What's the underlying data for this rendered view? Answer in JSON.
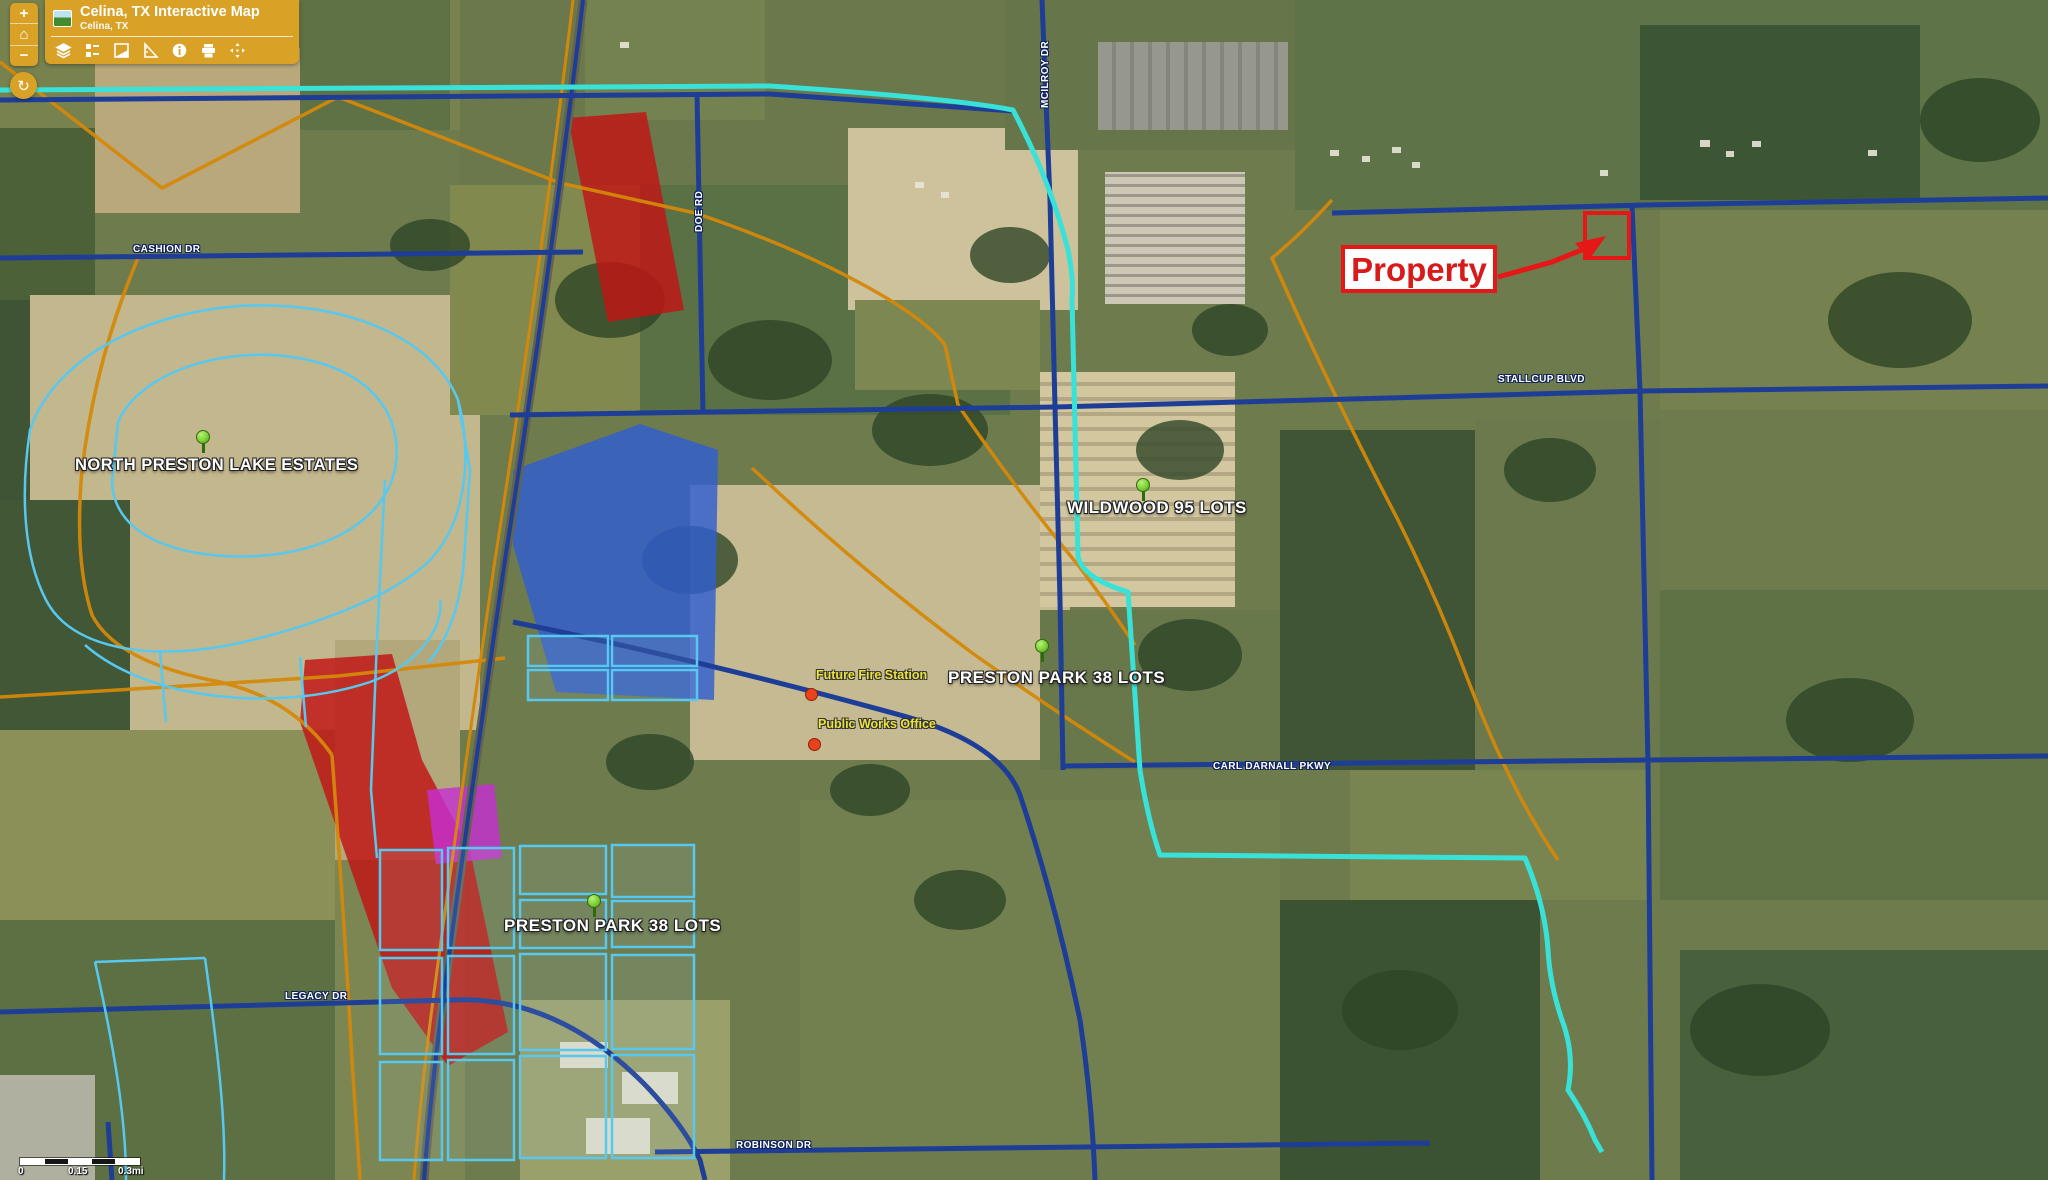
{
  "header": {
    "title": "Celina, TX Interactive Map",
    "subtitle": "Celina, TX",
    "tools": {
      "zoom_in": "+",
      "home": "⌂",
      "zoom_out": "−",
      "refresh": "↻"
    },
    "tool_icons": [
      "layers",
      "legend",
      "basemap",
      "measure",
      "info",
      "print",
      "pan"
    ]
  },
  "labels": {
    "subdivisions": [
      {
        "text": "NORTH PRESTON LAKE ESTATES"
      },
      {
        "text": "WILDWOOD 95 LOTS"
      },
      {
        "text": "PRESTON PARK 38 LOTS"
      },
      {
        "text": "PRESTON PARK 38 LOTS"
      }
    ],
    "roads": [
      {
        "text": "CASHION DR"
      },
      {
        "text": "DOE RD"
      },
      {
        "text": "MCILROY DR"
      },
      {
        "text": "STALLCUP BLVD"
      },
      {
        "text": "CARL DARNALL PKWY"
      },
      {
        "text": "LEGACY DR"
      },
      {
        "text": "ROBINSON DR"
      }
    ],
    "pois": [
      {
        "text": "Future Fire Station"
      },
      {
        "text": "Public Works Office"
      }
    ],
    "property_callout": "Property"
  },
  "scalebar": {
    "zero": "0",
    "mid": "0.15",
    "end": "0.3mi"
  },
  "colors": {
    "toolbar_amber": "#d9a227",
    "road_navy": "#1e3d96",
    "boundary_cyan": "#39e2d8",
    "subdivision_blue": "#57c8f0",
    "road_orange": "#d4880a",
    "overlay_red": "#c21313",
    "overlay_blue": "#2f5ed0",
    "overlay_magenta": "#c62fd2",
    "callout_red": "#e61717",
    "poi_yellow": "#ece33c",
    "pin_green": "#7ccf35"
  }
}
